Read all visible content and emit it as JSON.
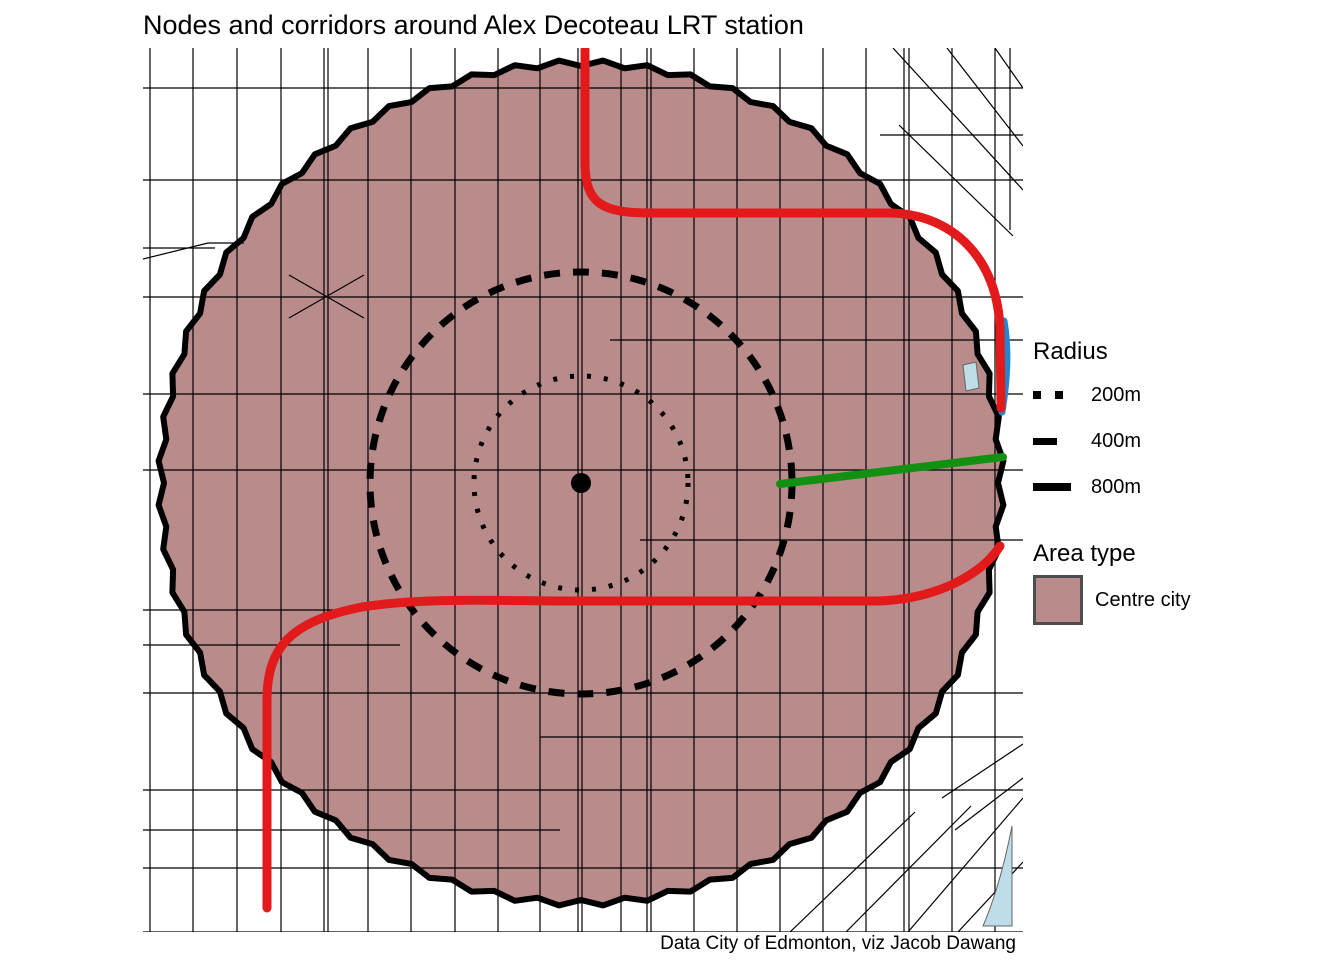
{
  "title": "Nodes and corridors around Alex Decoteau LRT station",
  "caption": "Data City of Edmonton, viz Jacob Dawang",
  "legend": {
    "radius": {
      "title": "Radius",
      "items": [
        {
          "label": "200m",
          "style": "dotted"
        },
        {
          "label": "400m",
          "style": "dashed"
        },
        {
          "label": "800m",
          "style": "solid"
        }
      ]
    },
    "area_type": {
      "title": "Area type",
      "items": [
        {
          "label": "Centre city",
          "fill": "#b98b8b"
        }
      ]
    }
  },
  "map": {
    "station_center": {
      "x": 581,
      "y": 483,
      "dot_r": 10
    },
    "rings": {
      "m200": {
        "r": 107
      },
      "m400": {
        "r": 211
      },
      "m800": {
        "r": 420,
        "jag": 3,
        "step_deg": 3
      }
    },
    "colors": {
      "area_fill": "#b98b8b",
      "boundary": "#000000",
      "street": "#000000",
      "corridor_red": "#e31a1c",
      "corridor_green": "#129012",
      "corridor_blue": "#2287cf",
      "water": "#bedde9"
    },
    "corridors": {
      "red_north": {
        "d": "M585,50 L585,162 C585,205 603,213 652,213 L888,213 C952,213 998,258 1000,330 L1001,408"
      },
      "red_south": {
        "d": "M267,908 L267,700 C267,646 292,621 362,607 C425,597 505,601 565,601 L878,601 C940,599 984,572 1000,546"
      },
      "green_east": {
        "d": "M780,484 L1003,457"
      },
      "blue_east": {
        "d": "M1004,321 C1009,350 1007,380 1002,412"
      }
    },
    "water_polygons": [
      "M963,365 L976,362 L979,388 L966,391 Z",
      "M1012,826 C1005,862 995,898 983,926 L1012,926 Z"
    ]
  }
}
